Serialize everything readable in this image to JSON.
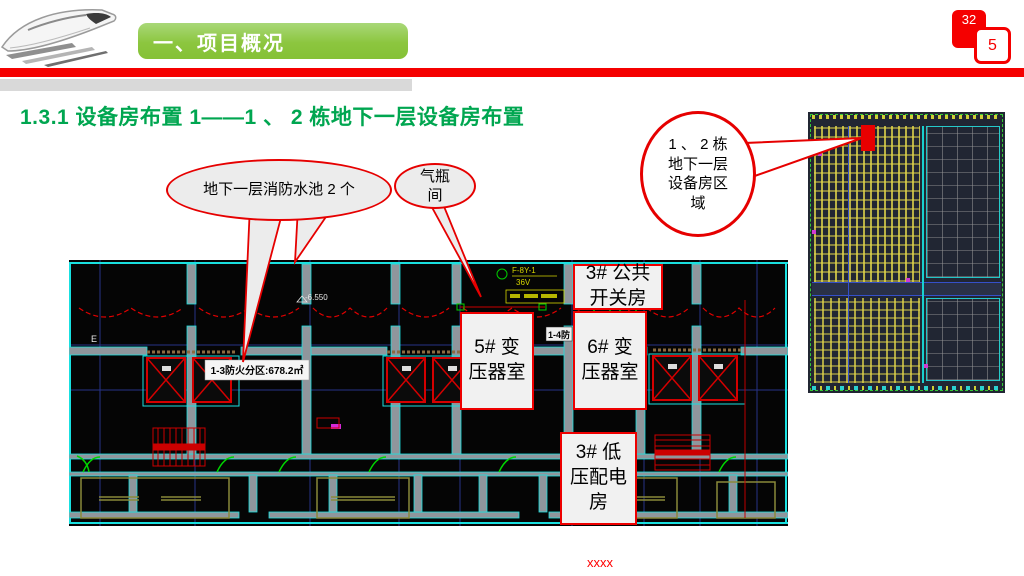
{
  "header": {
    "section_banner": "一、项目概况",
    "page_badge_back": "32",
    "page_badge_front": "5"
  },
  "title": "1.3.1  设备房布置 1——1 、 2 栋地下一层设备房布置",
  "callouts": {
    "fire_pool": "地下一层消防水池 2 个",
    "gas_room": "气瓶间",
    "region": "1 、 2 栋地下一层设备房区 域"
  },
  "room_labels": {
    "public_switch": "3# 公共开关房",
    "transformer5": "5# 变压器室",
    "transformer6": "6# 变压器室",
    "low_voltage": "3# 低压配电房"
  },
  "plan_annotations": {
    "fire_zone": "1-3防火分区:678.2㎡",
    "zone_chip": "1-4防",
    "device": "F-8Y-1",
    "device_sub": "36V",
    "elevation_a": "-6.550",
    "elevation_b": "-6.550",
    "grid_label": "E"
  },
  "footer": "xxxx",
  "colors": {
    "banner_green": "#8CC63F",
    "title_green": "#00A650",
    "accent_red": "#EE0000",
    "cad_cyan": "#19E0E0",
    "cad_yellow": "#D6D600"
  }
}
